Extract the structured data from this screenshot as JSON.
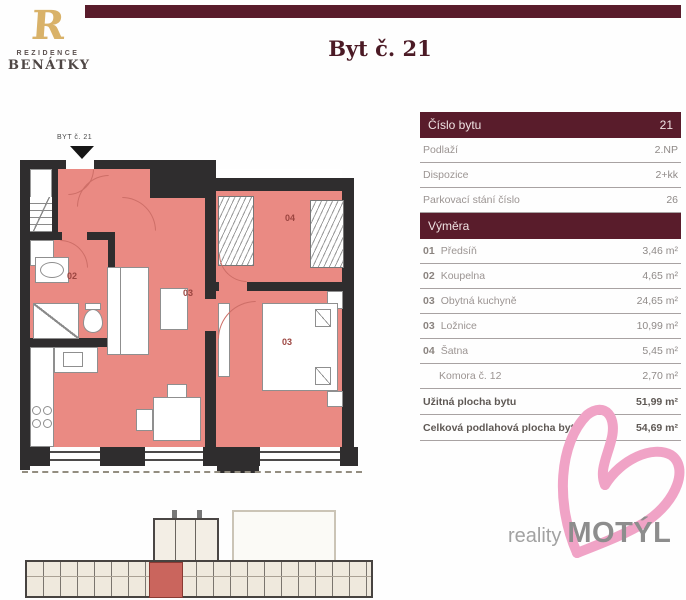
{
  "brand": {
    "monogram": "R",
    "line1": "REZIDENCE",
    "line2": "BENÁTKY"
  },
  "title": "Byt č. 21",
  "floorplan": {
    "entry_label": "BYT č. 21",
    "labels": {
      "bathroom": "02",
      "living": "03",
      "bedroom": "03",
      "wardrobe": "04"
    }
  },
  "table": {
    "header": {
      "label": "Číslo bytu",
      "value": "21"
    },
    "info_rows": [
      {
        "label": "Podlaží",
        "value": "2.NP"
      },
      {
        "label": "Dispozice",
        "value": "2+kk"
      },
      {
        "label": "Parkovací stání číslo",
        "value": "26"
      }
    ],
    "section_header": "Výměra",
    "area_rows": [
      {
        "num": "01",
        "label": "Předsíň",
        "value": "3,46 m²"
      },
      {
        "num": "02",
        "label": "Koupelna",
        "value": "4,65 m²"
      },
      {
        "num": "03",
        "label": "Obytná kuchyně",
        "value": "24,65 m²"
      },
      {
        "num": "03",
        "label": "Ložnice",
        "value": "10,99 m²"
      },
      {
        "num": "04",
        "label": "Šatna",
        "value": "5,45 m²"
      },
      {
        "num": "",
        "label": "Komora č. 12",
        "value": "2,70 m²"
      }
    ],
    "summary_rows": [
      {
        "label": "Užitná plocha bytu",
        "value": "51,99 m²"
      },
      {
        "label": "Celková podlahová plocha bytu",
        "value": "54,69 m²"
      }
    ]
  },
  "footer_logo": {
    "prefix": "reality",
    "name": "MOTÝL"
  },
  "colors": {
    "maroon": "#591c2b",
    "room_pink": "#ea8a83",
    "highlight_unit_red": "#ca655d",
    "butterfly_pink": "#f0a3c6",
    "brand_gold": "#d9b269"
  }
}
